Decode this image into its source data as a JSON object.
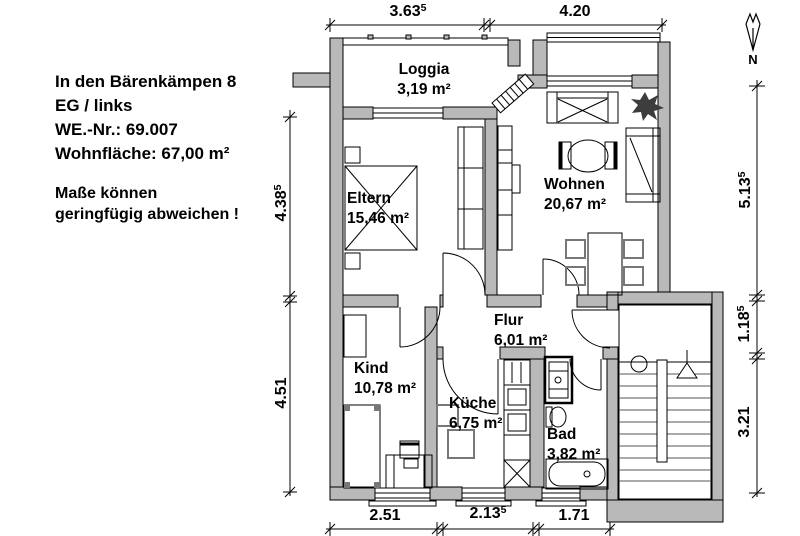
{
  "info": {
    "address": "In den Bärenkämpen 8",
    "floor": "EG / links",
    "unit_no": "WE.-Nr.: 69.007",
    "living_area": "Wohnfläche: 67,00 m²",
    "note_line1": "Maße können",
    "note_line2": "geringfügig abweichen !"
  },
  "north_label": "N",
  "rooms": [
    {
      "name": "Loggia",
      "area": "3,19 m²"
    },
    {
      "name": "Eltern",
      "area": "15,46 m²"
    },
    {
      "name": "Wohnen",
      "area": "20,67 m²"
    },
    {
      "name": "Flur",
      "area": "6,01 m²"
    },
    {
      "name": "Kind",
      "area": "10,78 m²"
    },
    {
      "name": "Küche",
      "area": "6,75 m²"
    },
    {
      "name": "Bad",
      "area": "3,82 m²"
    }
  ],
  "dimensions": {
    "top": [
      {
        "value": "3.63",
        "sup": "5"
      },
      {
        "value": "4.20",
        "sup": ""
      }
    ],
    "bottom": [
      {
        "value": "2.51",
        "sup": ""
      },
      {
        "value": "2.13",
        "sup": "5"
      },
      {
        "value": "1.71",
        "sup": ""
      }
    ],
    "left": [
      {
        "value": "4.38",
        "sup": "5"
      },
      {
        "value": "4.51",
        "sup": ""
      }
    ],
    "right": [
      {
        "value": "5.13",
        "sup": "5"
      },
      {
        "value": "1.18",
        "sup": "5"
      },
      {
        "value": "3.21",
        "sup": ""
      }
    ]
  },
  "colors": {
    "wall_fill": "#b9b9b9",
    "line": "#000000",
    "background": "#ffffff",
    "plant_fill": "#3d3d3d",
    "chair_stroke": "#777777"
  }
}
